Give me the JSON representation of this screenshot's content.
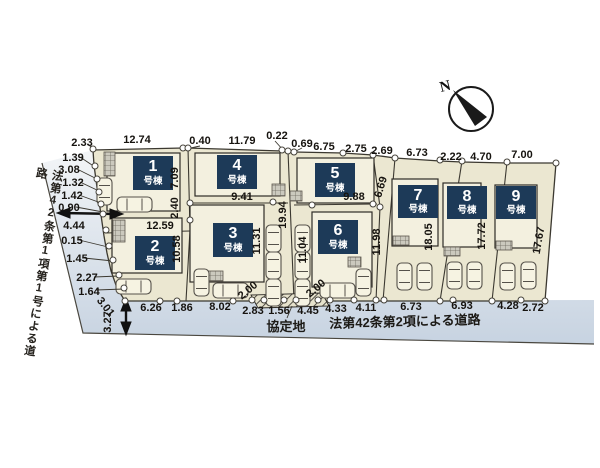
{
  "compass": {
    "north_label": "N"
  },
  "roads": {
    "west_road": "法第42条第1項第1号による道路",
    "south_road": "法第42条第2項による道路",
    "agreement_area": "協定地"
  },
  "buildings": [
    {
      "number": "1",
      "unit": "号棟"
    },
    {
      "number": "2",
      "unit": "号棟"
    },
    {
      "number": "3",
      "unit": "号棟"
    },
    {
      "number": "4",
      "unit": "号棟"
    },
    {
      "number": "5",
      "unit": "号棟"
    },
    {
      "number": "6",
      "unit": "号棟"
    },
    {
      "number": "7",
      "unit": "号棟"
    },
    {
      "number": "8",
      "unit": "号棟"
    },
    {
      "number": "9",
      "unit": "号棟"
    }
  ],
  "dimensions": {
    "top": [
      "2.33",
      "12.74",
      "0.40",
      "11.79",
      "0.22",
      "0.69",
      "6.75",
      "2.75",
      "2.69",
      "6.73",
      "2.22",
      "4.70",
      "7.00"
    ],
    "west": [
      "1.39",
      "3.08",
      "1.32",
      "1.42",
      "0.90",
      "4.44",
      "0.15",
      "1.45",
      "2.27",
      "1.64",
      "3.01",
      "3.27"
    ],
    "south": [
      "6.26",
      "1.86",
      "8.02",
      "2.83",
      "1.56",
      "4.45",
      "4.33",
      "4.11",
      "6.73",
      "6.93",
      "4.28",
      "2.72"
    ],
    "internal": [
      "7.09",
      "2.40",
      "12.59",
      "10.58",
      "9.41",
      "11.31",
      "19.94",
      "9.88",
      "6.69",
      "11.04",
      "11.98",
      "18.05",
      "17.72",
      "17.67"
    ],
    "walkway": [
      "2.00",
      "2.00"
    ]
  },
  "colors": {
    "lot_fill": "#ebe7d1",
    "building_fill": "#f3f0df",
    "label_bg": "#1d3a58",
    "road_fill": "#ccd7e3",
    "line": "#3b3830"
  }
}
